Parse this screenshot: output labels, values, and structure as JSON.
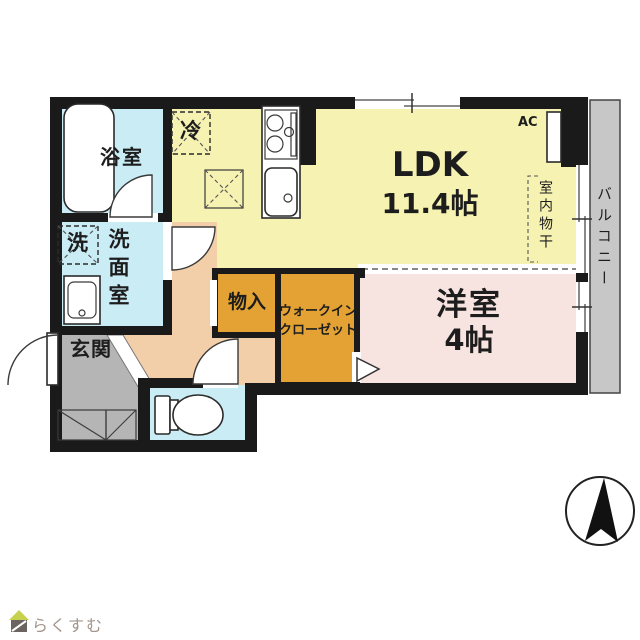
{
  "labels": {
    "bath": "浴室",
    "washer": "洗",
    "washroom": "洗面室",
    "fridge": "冷",
    "ldk_name": "LDK",
    "ldk_size": "11.4帖",
    "ac": "AC",
    "indoor_drying": "室内物干",
    "balcony": "バルコニー",
    "storage": "物入",
    "wic_line1": "ウォークイン",
    "wic_line2": "クローゼット",
    "western_name": "洋室",
    "western_size": "4帖",
    "entrance": "玄関",
    "watermark": "らくすむ"
  },
  "icons": {
    "compass": "north-arrow-icon",
    "logo": "house-icon"
  },
  "colors": {
    "wall": "#1a1a1a",
    "ldk_yellow": "#f6f2b2",
    "room_cyan": "#c9ecf5",
    "closet_orange": "#e3a233",
    "western_pink": "#f7e3e0",
    "entrance_gray": "#b5b5b5",
    "hallway_peach": "#f3cfa9",
    "balcony_gray": "#c7c7c7"
  }
}
